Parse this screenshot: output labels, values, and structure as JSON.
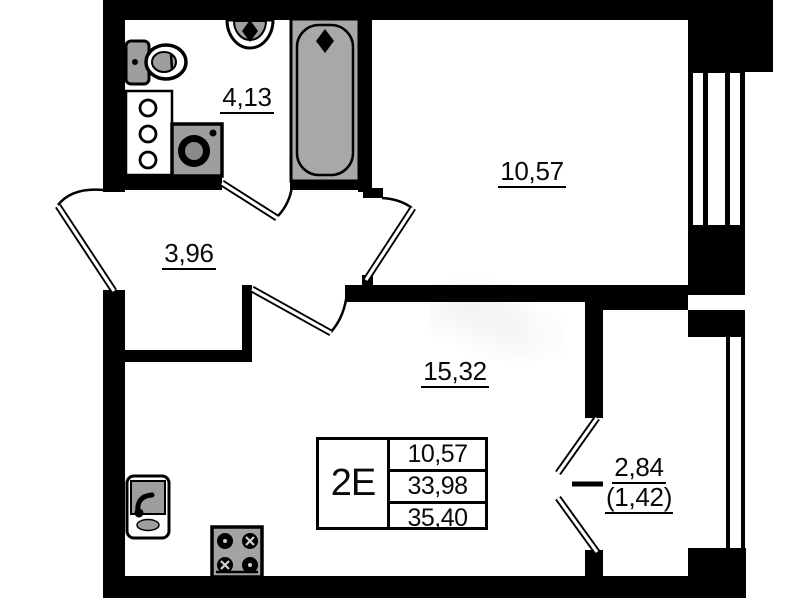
{
  "plan": {
    "rooms": {
      "bathroom": {
        "area": "4,13"
      },
      "hallway": {
        "area": "3,96"
      },
      "bedroom": {
        "area": "10,57"
      },
      "living_kitchen": {
        "area": "15,32"
      },
      "balcony": {
        "area": "2,84",
        "area_coef": "(1,42)"
      }
    },
    "summary": {
      "unit_label": "2E",
      "living_area": "10,57",
      "area_without_balcony": "33,98",
      "area_total": "35,40"
    },
    "colors": {
      "wall": "#000000",
      "fixture_gray": "#9e9e9e",
      "background": "#ffffff"
    }
  }
}
